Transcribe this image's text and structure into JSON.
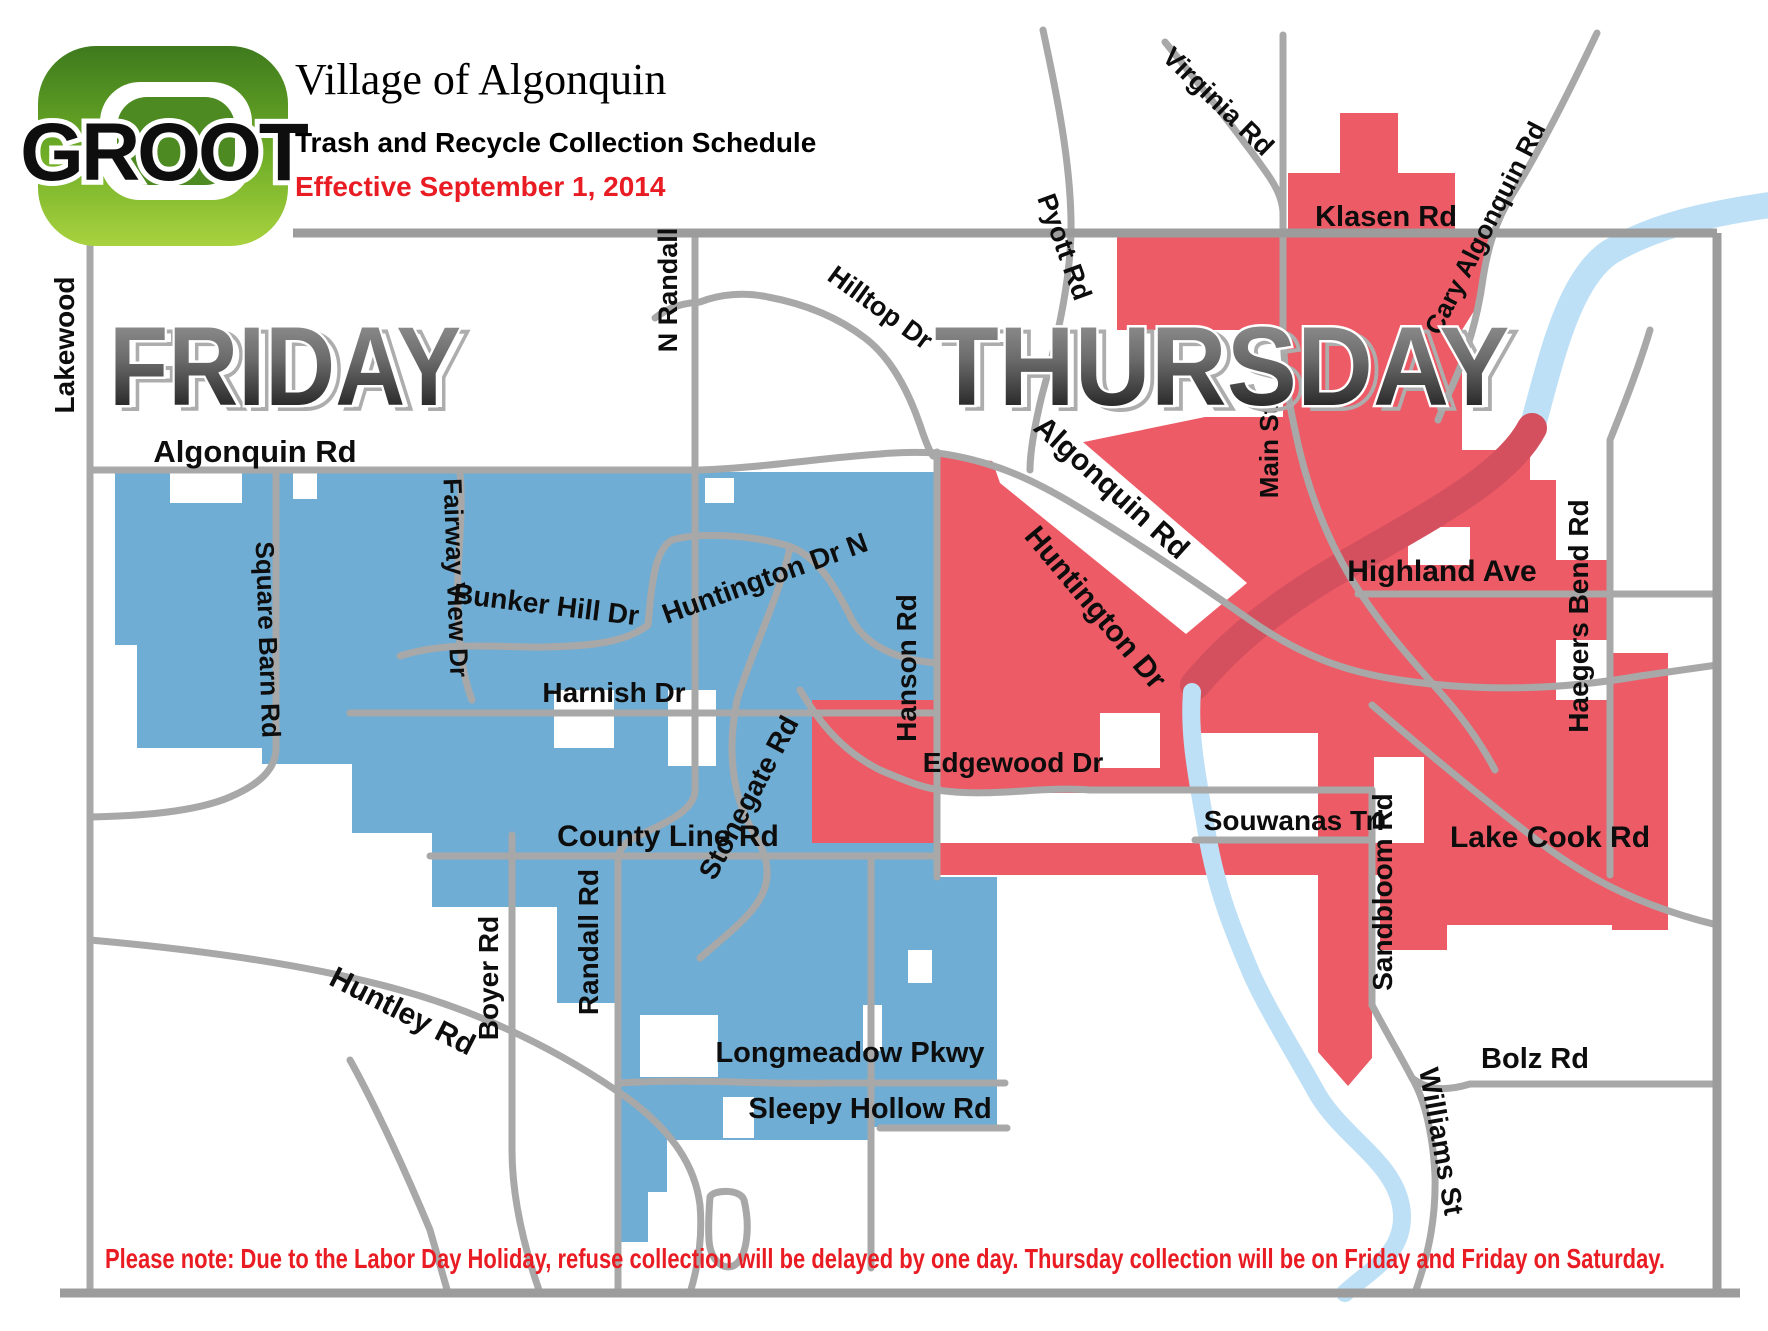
{
  "header": {
    "brand": "GROOT",
    "title": "Village of Algonquin",
    "subtitle": "Trash and Recycle Collection Schedule",
    "effective": "Effective September 1, 2014",
    "effective_color": "#EA1C23"
  },
  "zones": {
    "friday": {
      "label": "FRIDAY",
      "color": "#6FADD4"
    },
    "thursday": {
      "label": "THURSDAY",
      "color": "#ED5B66"
    }
  },
  "map": {
    "river_color": "#BDE0F6",
    "river_over_red_color": "#D5505E",
    "road_color": "#A8A8A8",
    "road_labels": [
      {
        "text": "Lakewood"
      },
      {
        "text": "Algonquin Rd"
      },
      {
        "text": "N Randall"
      },
      {
        "text": "Hilltop Dr"
      },
      {
        "text": "Pyott Rd"
      },
      {
        "text": "Virginia Rd"
      },
      {
        "text": "Klasen Rd"
      },
      {
        "text": "Cary Algonquin Rd"
      },
      {
        "text": "Main St"
      },
      {
        "text": "Algonquin  Rd"
      },
      {
        "text": "Huntington  Dr"
      },
      {
        "text": "Highland Ave"
      },
      {
        "text": "Haegers Bend Rd"
      },
      {
        "text": "Fairway View Dr"
      },
      {
        "text": "Square Barn Rd"
      },
      {
        "text": "Bunker Hill Dr"
      },
      {
        "text": "Huntington Dr N"
      },
      {
        "text": "Hanson Rd"
      },
      {
        "text": "Harnish  Dr"
      },
      {
        "text": "Edgewood Dr"
      },
      {
        "text": "Stonegate Rd"
      },
      {
        "text": "County Line Rd"
      },
      {
        "text": "Souwanas Trl"
      },
      {
        "text": "Sandbloom Rd"
      },
      {
        "text": "Lake Cook Rd"
      },
      {
        "text": "Boyer Rd"
      },
      {
        "text": "Randall Rd"
      },
      {
        "text": "Huntley Rd"
      },
      {
        "text": "Longmeadow Pkwy"
      },
      {
        "text": "Sleepy Hollow Rd"
      },
      {
        "text": "Bolz Rd"
      },
      {
        "text": "Williams St"
      }
    ]
  },
  "footer": {
    "note": "Please note: Due to the Labor Day Holiday, refuse collection will be delayed by one day.  Thursday collection will be on Friday and Friday on Saturday.",
    "note_color": "#EA1C23"
  }
}
